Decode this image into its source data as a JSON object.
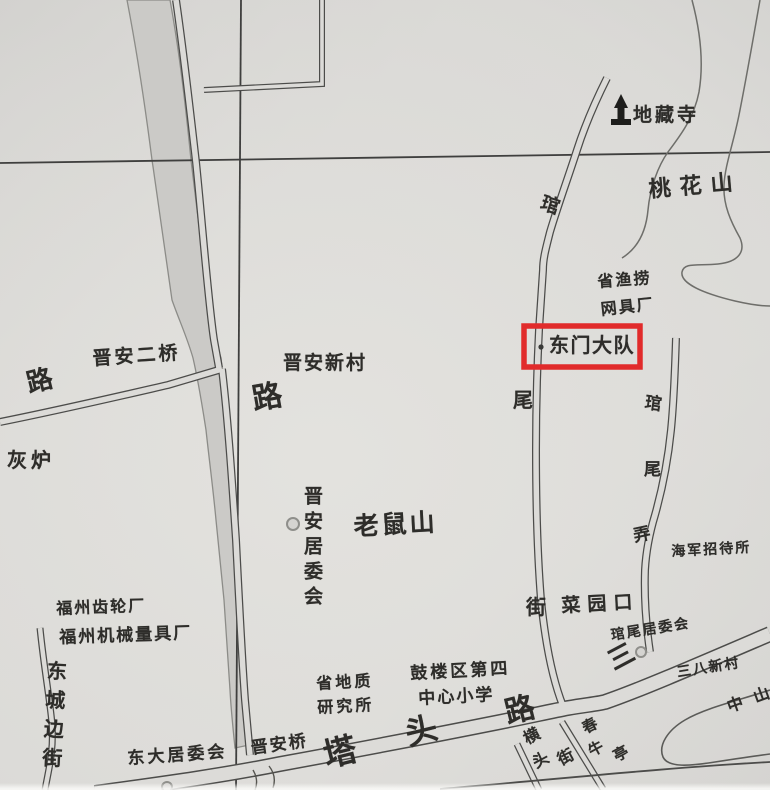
{
  "map": {
    "description": "Scanned street map of the Jin'an / Guanwei area of Fuzhou with a red highlight box",
    "highlight": {
      "color": "#e12b2b"
    },
    "colors": {
      "paper": "#dcdbd8",
      "ink": "#3c3b39",
      "river": "#cbcac7",
      "line_gray": "#8c8c88",
      "highlight": "#e12b2b"
    },
    "symbols": {
      "temple": "temple-icon",
      "committee_point": "circle-marker",
      "locator_dot": "dot-marker"
    },
    "labels": {
      "dizangsi": "地藏寺",
      "taohuashan": "桃花山",
      "shengyulao": "省渔捞",
      "wangjuchang": "网具厂",
      "dongmendadui": "东门大队",
      "jinan_erqiao": "晋安二桥",
      "jinan_xincun": "晋安新村",
      "lu_west": "路",
      "lu_junction": "路",
      "huilu": "灰炉",
      "jinan_juweihui": "晋安居委会",
      "laoshushan": "老鼠山",
      "wei_mid": "尾",
      "guan_top": "琯",
      "jie_bottom": "街",
      "guan_2": "琯",
      "wei_2": "尾",
      "long_2": "弄",
      "haijun_zhaodaisuo": "海军招待所",
      "caiyuankou": "菜园口",
      "guanwei_juweihui": "琯尾居委会",
      "san_big": "三",
      "sanba_xincun": "三八新村",
      "zhongshan": "中山",
      "fuzhou_chilunchang": "福州齿轮厂",
      "fuzhou_jixie": "福州机械量具厂",
      "dongchengbianjie": "东城边街",
      "dongda_juweihui": "东大居委会",
      "jinanqiao": "晋安桥",
      "shengdizhi": "省地质",
      "yanjiusuo": "研究所",
      "gulouqu": "鼓楼区第四",
      "zhongxinxiaoxue": "中心小学",
      "ta_big": "塔",
      "tou_big": "头",
      "lu_big": "路",
      "heng": "横",
      "tou_2": "头",
      "jie_2": "街",
      "chun": "春",
      "niu": "牛",
      "ting": "亭"
    }
  }
}
